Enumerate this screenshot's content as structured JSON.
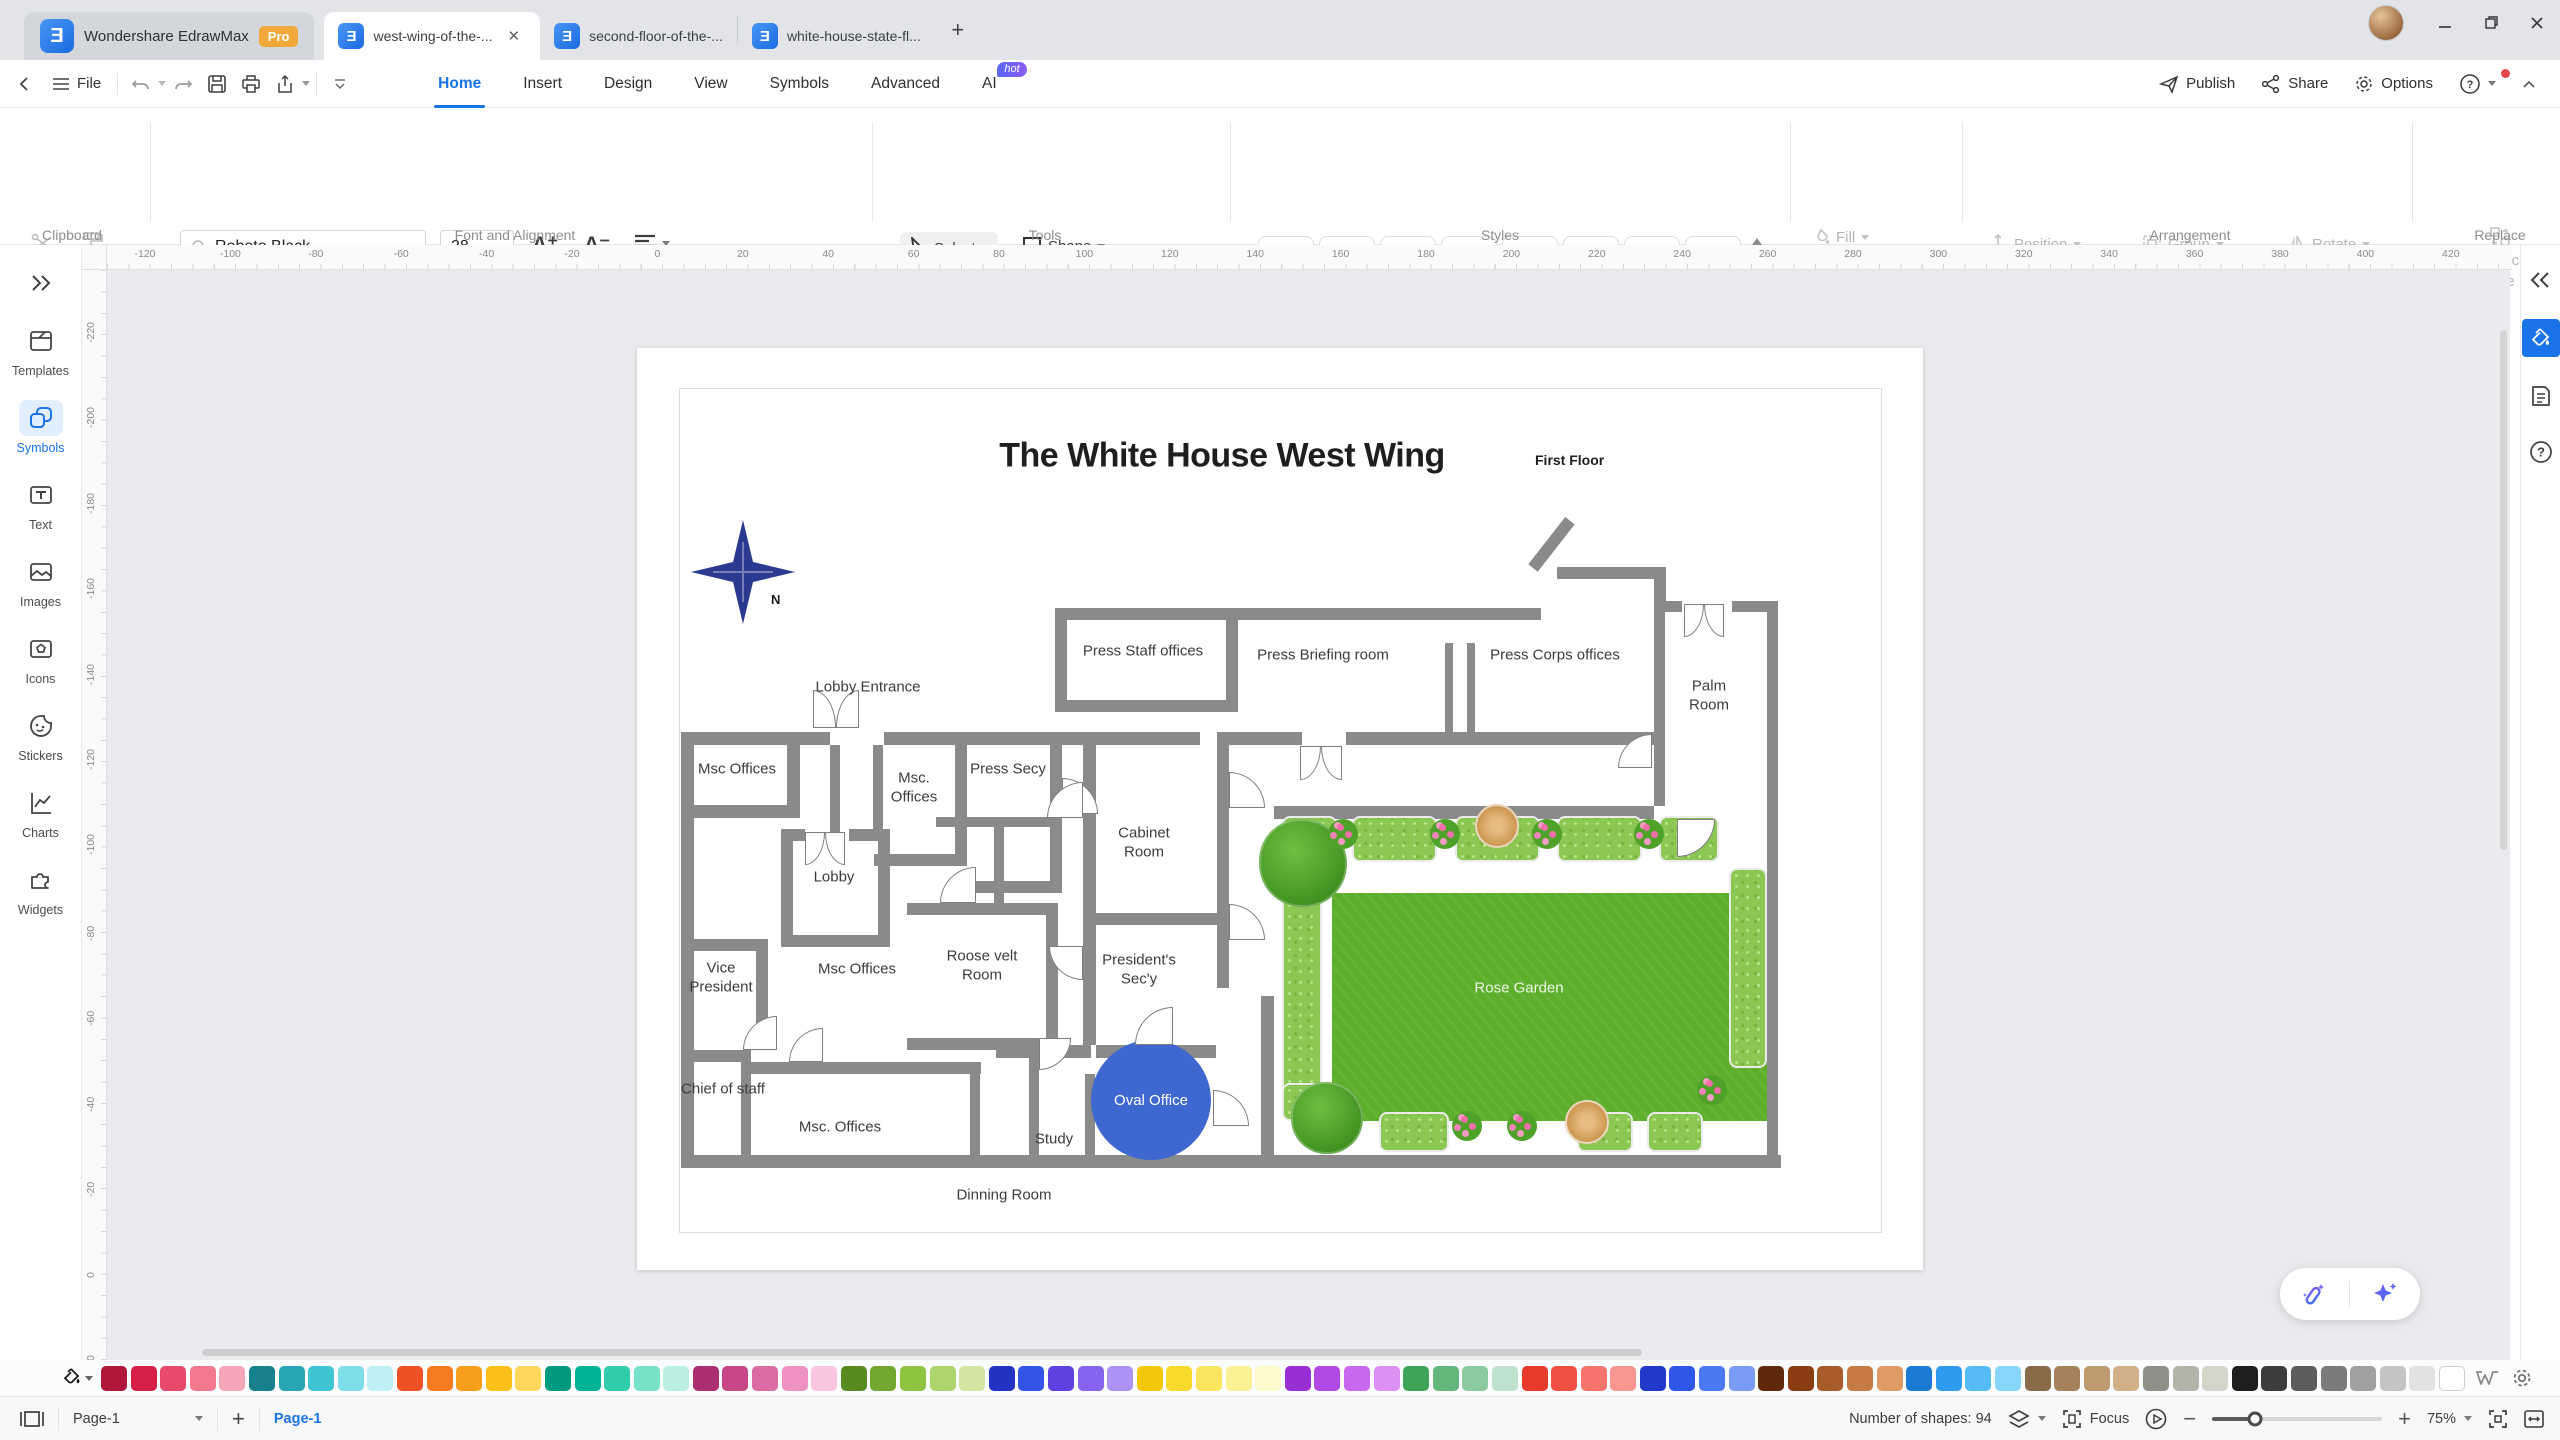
{
  "titlebar": {
    "app_name": "Wondershare EdrawMax",
    "pro_badge": "Pro",
    "logo_glyph": "Ǝ",
    "tabs": [
      {
        "label": "west-wing-of-the-..."
      },
      {
        "label": "second-floor-of-the-..."
      },
      {
        "label": "white-house-state-fl..."
      }
    ],
    "close_glyph": "✕"
  },
  "menubar": {
    "file": "File",
    "nav": [
      "Home",
      "Insert",
      "Design",
      "View",
      "Symbols",
      "Advanced",
      "AI"
    ],
    "active_nav": "Home",
    "ai_badge": "hot",
    "publish": "Publish",
    "share": "Share",
    "options": "Options"
  },
  "ribbon": {
    "captions": {
      "clipboard": "Clipboard",
      "font": "Font and Alignment",
      "tools": "Tools",
      "styles": "Styles",
      "arrangement": "Arrangement",
      "replace": "Replace"
    },
    "font": {
      "family": "Roboto Black",
      "size": "28"
    },
    "glyphs": {
      "bold": "B",
      "italic": "I",
      "underline": "U",
      "strike": "S",
      "sup": "X²",
      "sub": "X₂",
      "tcolor": "T",
      "ab": "ab",
      "fcolor": "A"
    },
    "tools": {
      "select": "Select",
      "shape": "Shape",
      "text": "Text",
      "connector": "Connector"
    },
    "styles_items": [
      "Abc",
      "Abc",
      "Abc",
      "Abc",
      "Abc",
      "Abc",
      "Abc",
      "Abc"
    ],
    "fls": {
      "fill": "Fill",
      "line": "Line",
      "shadow": "Shadow"
    },
    "arrangement": {
      "position": "Position",
      "group": "Group",
      "rotate": "Rotate",
      "align": "Align",
      "size": "Size",
      "lock": "Lock"
    },
    "replace": {
      "line1": "Replace",
      "line2": "Shape"
    }
  },
  "sidebar": {
    "items": [
      {
        "label": "Templates",
        "icon": "templates-icon",
        "active": false
      },
      {
        "label": "Symbols",
        "icon": "symbols-icon",
        "active": true
      },
      {
        "label": "Text",
        "icon": "text-icon",
        "active": false
      },
      {
        "label": "Images",
        "icon": "images-icon",
        "active": false
      },
      {
        "label": "Icons",
        "icon": "icons-icon",
        "active": false
      },
      {
        "label": "Stickers",
        "icon": "stickers-icon",
        "active": false
      },
      {
        "label": "Charts",
        "icon": "charts-icon",
        "active": false
      },
      {
        "label": "Widgets",
        "icon": "widgets-icon",
        "active": false
      }
    ]
  },
  "rulers": {
    "h": [
      -120,
      -100,
      -80,
      -60,
      -40,
      -20,
      0,
      20,
      40,
      60,
      80,
      100,
      120,
      140,
      160,
      180,
      200,
      220,
      240,
      260,
      280,
      300,
      320,
      340,
      360,
      380,
      400,
      420
    ],
    "v": [
      -220,
      -200,
      -180,
      -160,
      -140,
      -120,
      -100,
      -80,
      -60,
      -40,
      -20,
      0,
      20
    ],
    "start_h": 63,
    "start_v": 60,
    "step_px": 85.4
  },
  "canvas": {
    "title": "The White House West Wing",
    "subtitle": "First Floor",
    "north_label": "N",
    "compass_color": "#2b3a90",
    "floorplan": {
      "wall_color": "#8a8a8a",
      "walls": [
        [
          44,
          384,
          149,
          13
        ],
        [
          247,
          384,
          316,
          13
        ],
        [
          580,
          384,
          85,
          13
        ],
        [
          709,
          384,
          308,
          13
        ],
        [
          418,
          260,
          183,
          12
        ],
        [
          418,
          260,
          12,
          104
        ],
        [
          589,
          260,
          12,
          104
        ],
        [
          418,
          352,
          183,
          12
        ],
        [
          601,
          260,
          303,
          12
        ],
        [
          920,
          219,
          97,
          12
        ],
        [
          1017,
          219,
          12,
          45
        ],
        [
          1017,
          253,
          28,
          11
        ],
        [
          1095,
          253,
          46,
          11
        ],
        [
          1017,
          264,
          11,
          194
        ],
        [
          1130,
          253,
          11,
          560
        ],
        [
          808,
          295,
          8,
          92
        ],
        [
          830,
          295,
          8,
          92
        ],
        [
          637,
          458,
          380,
          13
        ],
        [
          624,
          648,
          13,
          172
        ],
        [
          44,
          384,
          13,
          436
        ],
        [
          44,
          807,
          1100,
          13
        ],
        [
          44,
          457,
          119,
          13
        ],
        [
          150,
          397,
          13,
          73
        ],
        [
          193,
          397,
          10,
          88
        ],
        [
          236,
          397,
          10,
          88
        ],
        [
          144,
          481,
          12,
          118
        ],
        [
          241,
          481,
          12,
          118
        ],
        [
          144,
          587,
          109,
          12
        ],
        [
          144,
          481,
          24,
          12
        ],
        [
          212,
          481,
          41,
          12
        ],
        [
          318,
          397,
          12,
          121
        ],
        [
          237,
          506,
          93,
          12
        ],
        [
          413,
          397,
          12,
          148
        ],
        [
          318,
          533,
          107,
          12
        ],
        [
          270,
          555,
          151,
          12
        ],
        [
          409,
          555,
          12,
          147
        ],
        [
          270,
          690,
          151,
          12
        ],
        [
          299,
          469,
          126,
          10
        ],
        [
          357,
          479,
          10,
          76
        ],
        [
          446,
          397,
          13,
          180
        ],
        [
          580,
          397,
          12,
          243
        ],
        [
          446,
          565,
          146,
          12
        ],
        [
          446,
          577,
          13,
          120
        ],
        [
          359,
          697,
          95,
          13
        ],
        [
          459,
          697,
          120,
          13
        ],
        [
          392,
          710,
          10,
          97
        ],
        [
          448,
          726,
          10,
          81
        ],
        [
          114,
          714,
          230,
          12
        ],
        [
          333,
          714,
          10,
          93
        ],
        [
          104,
          714,
          10,
          93
        ],
        [
          44,
          702,
          70,
          12
        ],
        [
          44,
          591,
          87,
          12
        ],
        [
          119,
          591,
          12,
          111
        ]
      ],
      "diagonals": [
        [
          896,
          214,
          60,
          12,
          -52
        ]
      ],
      "rooms": [
        {
          "t": "Press Staff offices",
          "x": 506,
          "y": 304,
          "w": 200
        },
        {
          "t": "Press Briefing room",
          "x": 686,
          "y": 308,
          "w": 220
        },
        {
          "t": "Press Corps offices",
          "x": 918,
          "y": 308,
          "w": 220
        },
        {
          "t": "Palm Room",
          "x": 1072,
          "y": 348,
          "w": 70
        },
        {
          "t": "Lobby Entrance",
          "x": 231,
          "y": 340,
          "w": 160
        },
        {
          "t": "Msc Offices",
          "x": 100,
          "y": 422,
          "w": 100
        },
        {
          "t": "Msc. Offices",
          "x": 277,
          "y": 440,
          "w": 60
        },
        {
          "t": "Press Secy",
          "x": 371,
          "y": 422,
          "w": 100
        },
        {
          "t": "Cabinet Room",
          "x": 507,
          "y": 495,
          "w": 70
        },
        {
          "t": "Lobby",
          "x": 197,
          "y": 530,
          "w": 80
        },
        {
          "t": "Msc Offices",
          "x": 220,
          "y": 622,
          "w": 120
        },
        {
          "t": "Roose velt Room",
          "x": 345,
          "y": 618,
          "w": 100
        },
        {
          "t": "Vice President",
          "x": 84,
          "y": 630,
          "w": 85
        },
        {
          "t": "President's Sec'y",
          "x": 502,
          "y": 622,
          "w": 100
        },
        {
          "t": "Chief of staff",
          "x": 86,
          "y": 742,
          "w": 85
        },
        {
          "t": "Msc. Offices",
          "x": 203,
          "y": 780,
          "w": 140
        },
        {
          "t": "Study",
          "x": 417,
          "y": 792,
          "w": 70
        },
        {
          "t": "Dinning Room",
          "x": 367,
          "y": 848,
          "w": 110
        }
      ],
      "doors": [
        {
          "x": 176,
          "y": 342,
          "s": 46,
          "double": true,
          "dir": "up"
        },
        {
          "x": 663,
          "y": 398,
          "s": 42,
          "double": true,
          "dir": "down"
        },
        {
          "x": 1047,
          "y": 256,
          "s": 40,
          "double": true,
          "dir": "down"
        },
        {
          "x": 168,
          "y": 484,
          "s": 40,
          "double": true,
          "dir": "down"
        },
        {
          "x": 425,
          "y": 430,
          "s": 36,
          "c": 1
        },
        {
          "x": 410,
          "y": 434,
          "s": 36,
          "c": 0
        },
        {
          "x": 592,
          "y": 424,
          "s": 36,
          "c": 1
        },
        {
          "x": 592,
          "y": 556,
          "s": 36,
          "c": 1
        },
        {
          "x": 981,
          "y": 386,
          "s": 34,
          "c": 0
        },
        {
          "x": 1040,
          "y": 471,
          "s": 38,
          "c": 2
        },
        {
          "x": 303,
          "y": 519,
          "s": 36,
          "c": 0
        },
        {
          "x": 498,
          "y": 659,
          "s": 38,
          "c": 0
        },
        {
          "x": 576,
          "y": 742,
          "s": 36,
          "c": 1
        },
        {
          "x": 106,
          "y": 668,
          "s": 34,
          "c": 0
        },
        {
          "x": 152,
          "y": 680,
          "s": 34,
          "c": 0
        },
        {
          "x": 412,
          "y": 598,
          "s": 34,
          "c": 3
        },
        {
          "x": 402,
          "y": 690,
          "s": 32,
          "c": 2
        }
      ],
      "oval_office": {
        "label": "Oval Office",
        "cx": 514,
        "cy": 752,
        "rx": 60,
        "ry": 60,
        "color": "#3e68d0"
      },
      "garden": {
        "label": "Rose Garden",
        "label_pos": [
          882,
          640
        ],
        "lawn": [
          695,
          545,
          435,
          228
        ],
        "hedges": [
          [
            645,
            468,
            55,
            46
          ],
          [
            715,
            468,
            85,
            46
          ],
          [
            818,
            468,
            85,
            46
          ],
          [
            920,
            468,
            85,
            46
          ],
          [
            1022,
            468,
            60,
            46
          ],
          [
            645,
            528,
            40,
            245
          ],
          [
            645,
            735,
            56,
            38
          ],
          [
            742,
            764,
            70,
            40
          ],
          [
            940,
            764,
            56,
            40
          ],
          [
            1010,
            764,
            56,
            40
          ],
          [
            1092,
            520,
            38,
            200
          ]
        ],
        "trees_green": [
          [
            666,
            515,
            88
          ],
          [
            690,
            770,
            72
          ]
        ],
        "trees_tan": [
          [
            860,
            478,
            44
          ],
          [
            950,
            774,
            44
          ]
        ],
        "flowers": [
          [
            706,
            486
          ],
          [
            808,
            486
          ],
          [
            910,
            486
          ],
          [
            1012,
            486
          ],
          [
            830,
            778
          ],
          [
            885,
            778
          ],
          [
            1075,
            742
          ]
        ]
      }
    }
  },
  "ai_pill": {
    "icons": [
      "magic-wand-icon",
      "ai-sparkle-icon"
    ]
  },
  "palette": {
    "colors": [
      "#b0173a",
      "#d61f48",
      "#e74a6d",
      "#f1788f",
      "#f7a6b8",
      "#17808d",
      "#29a6b4",
      "#3fc4d2",
      "#7fdde8",
      "#bff0f5",
      "#ee5126",
      "#f47b20",
      "#f99e1b",
      "#fbc018",
      "#fdd75c",
      "#019a7f",
      "#00b393",
      "#2fcda9",
      "#78e2c8",
      "#baf0e1",
      "#ab2f70",
      "#c64686",
      "#da6ba3",
      "#ee92c2",
      "#f9c5e0",
      "#558b1f",
      "#71a72e",
      "#8ec43f",
      "#aed46d",
      "#d0e6a2",
      "#2433c4",
      "#3353e6",
      "#5f41e2",
      "#8763ee",
      "#ad92f4",
      "#f3c70b",
      "#f7da2a",
      "#fae65e",
      "#fcf095",
      "#fef9ca",
      "#992fd3",
      "#b14ae5",
      "#c868ee",
      "#dd90f4",
      "#40a457",
      "#63b77b",
      "#8ccaa0",
      "#bfe2cc",
      "#e53a2c",
      "#ef5043",
      "#f4746b",
      "#f89691",
      "#2238c9",
      "#3056e8",
      "#4b79f1",
      "#7b9cf6",
      "#5f2a0c",
      "#8a3d10",
      "#a85c2a",
      "#c77b45",
      "#e09a64",
      "#1b7ad3",
      "#2f9bee",
      "#56bbf6",
      "#86d7fa",
      "#8a6b47",
      "#a5825a",
      "#bd9a70",
      "#d2b189",
      "#8f8f85",
      "#b3b3a8",
      "#d4d4c8",
      "#1e1e1e",
      "#3d3d3d",
      "#5c5c5c",
      "#7b7b7b",
      "#a0a0a0",
      "#c4c4c4",
      "#e2e2e2",
      "#ffffff"
    ]
  },
  "statusbar": {
    "page_dropdown": "Page-1",
    "page_tab": "Page-1",
    "shapes_count": "Number of shapes: 94",
    "focus_label": "Focus",
    "zoom_value": "75%"
  }
}
